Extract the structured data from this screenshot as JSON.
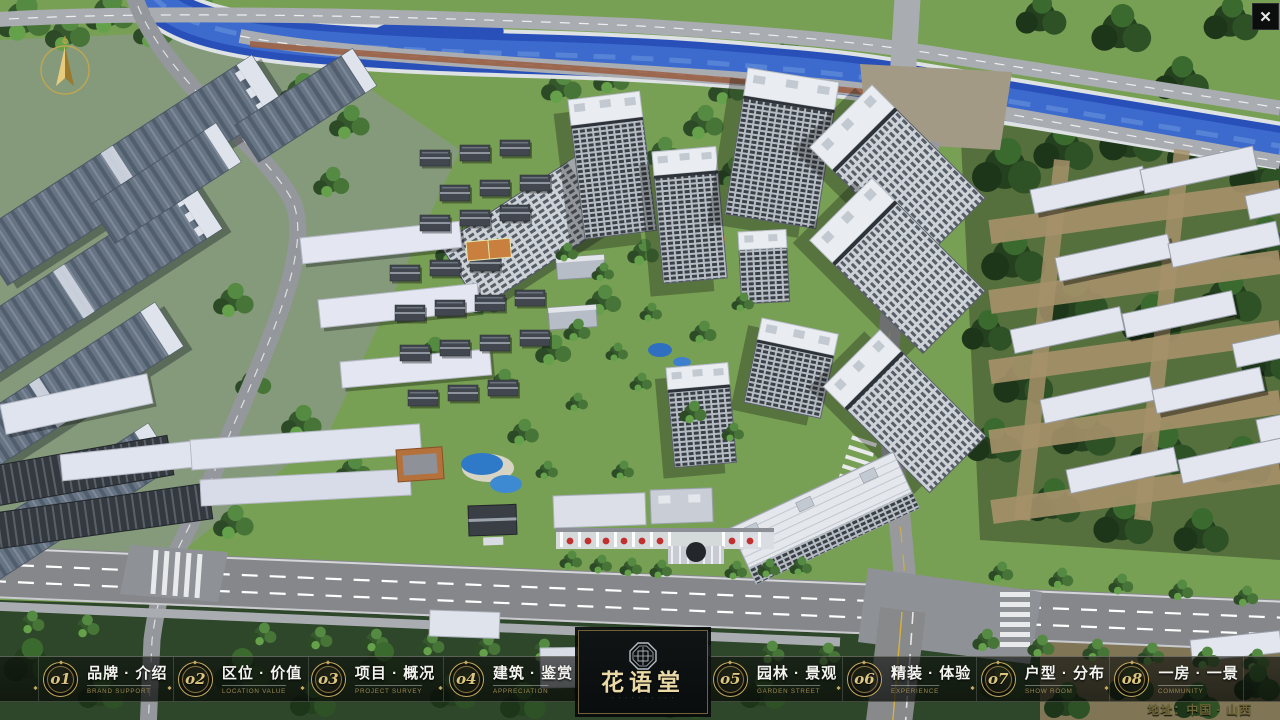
{
  "app": {
    "close_glyph": "✕"
  },
  "menu": {
    "items": [
      {
        "num": "o1",
        "zh": "品牌 · 介绍",
        "en": "BRAND SUPPORT"
      },
      {
        "num": "o2",
        "zh": "区位 · 价值",
        "en": "LOCATION VALUE"
      },
      {
        "num": "o3",
        "zh": "项目 · 概况",
        "en": "PROJECT SURVEY"
      },
      {
        "num": "o4",
        "zh": "建筑 · 鉴赏",
        "en": "APPRECIATION"
      },
      {
        "num": "o5",
        "zh": "园林 · 景观",
        "en": "GARDEN STREET"
      },
      {
        "num": "o6",
        "zh": "精装 · 体验",
        "en": "EXPERIENCE"
      },
      {
        "num": "o7",
        "zh": "户型 · 分布",
        "en": "SHOW ROOM"
      },
      {
        "num": "o8",
        "zh": "一房 · 一景",
        "en": "COMMUNITY"
      }
    ]
  },
  "logo": {
    "name": "花语堂",
    "tagline": "· · · · · · · · · ·"
  },
  "footer": {
    "address": "地址：中国 · 山西"
  },
  "colors": {
    "gold_accent": "#c6a95f",
    "bar_background": "rgba(10,12,10,0.65)",
    "river_blue": "#2850b8",
    "label_white": "#f4f4f1",
    "english_gold": "#9b8850"
  }
}
